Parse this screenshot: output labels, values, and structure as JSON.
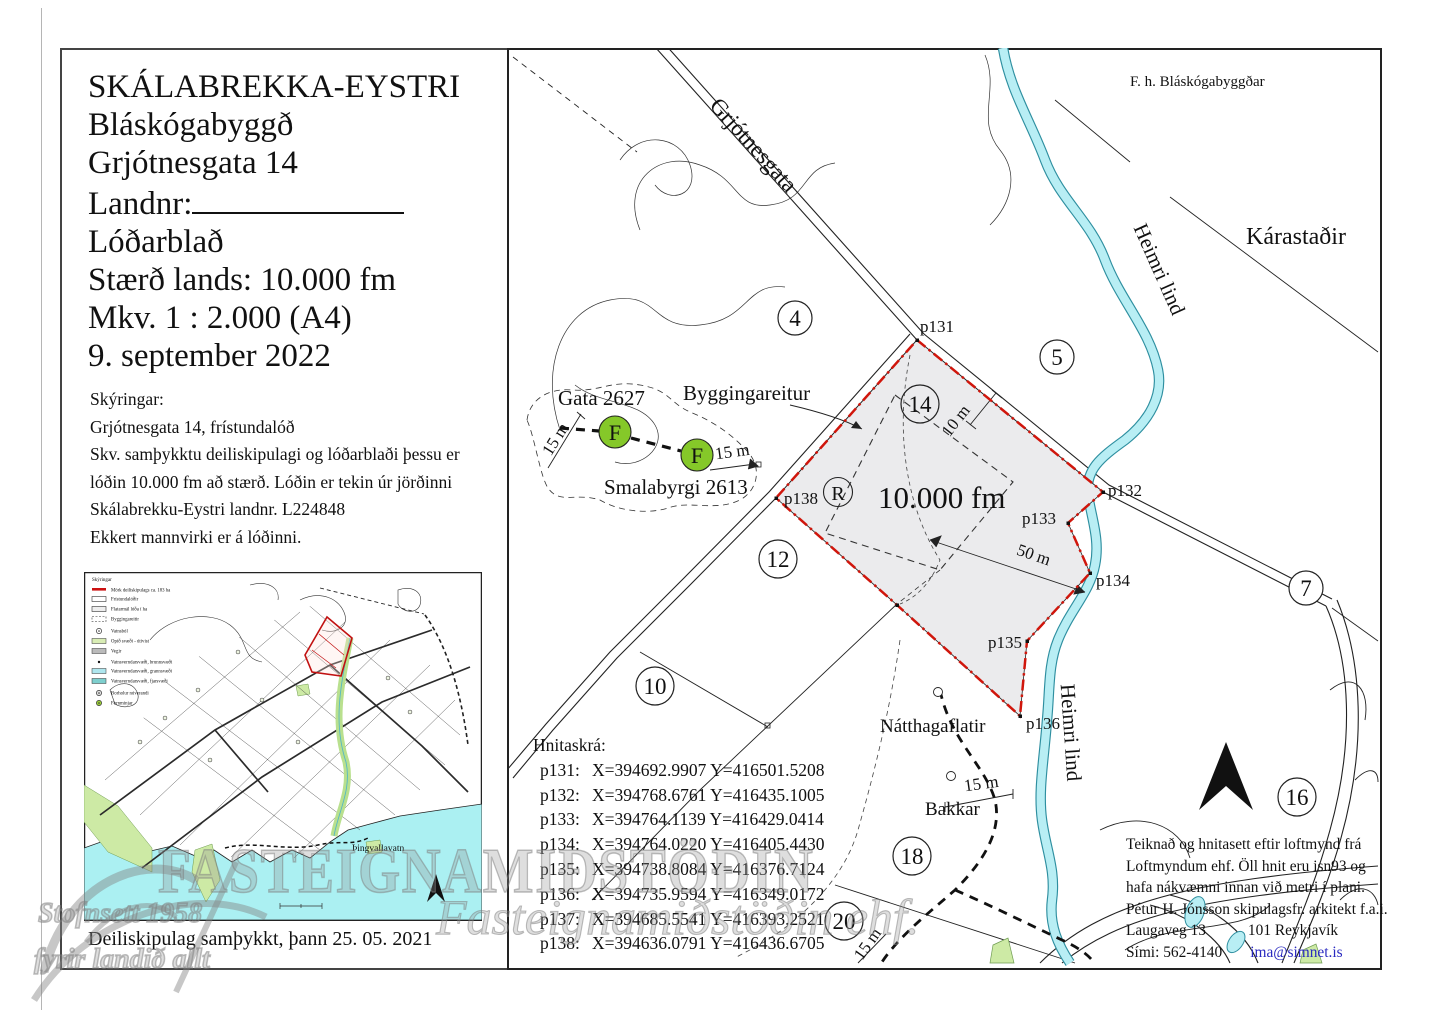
{
  "title_block": {
    "property": "SKÁLABREKKA-EYSTRI",
    "municipality": "Bláskógabyggð",
    "address": "Grjótnesgata 14",
    "landnr_label": "Landnr:",
    "doc_type": "Lóðarblað",
    "size": "Stærð lands: 10.000 fm",
    "scale": "Mkv. 1 : 2.000 (A4)",
    "date": "9. september 2022"
  },
  "skyringar": {
    "heading": "Skýringar:",
    "line1": "Grjótnesgata 14, frístundalóð",
    "line2": "Skv. samþykktu deiliskipulagi og lóðarblaði þessu er",
    "line3": "lóðin 10.000 fm að stærð.   Lóðin er tekin úr jörðinni",
    "line4": "Skálabrekku-Eystri landnr. L224848",
    "line5": "Ekkert mannvirki er á lóðinni."
  },
  "hnitaskra": {
    "heading": "Hnitaskrá:",
    "rows": [
      {
        "id": "p131:",
        "coords": "X=394692.9907 Y=416501.5208"
      },
      {
        "id": "p132:",
        "coords": "X=394768.6761 Y=416435.1005"
      },
      {
        "id": "p133:",
        "coords": "X=394764.1139 Y=416429.0414"
      },
      {
        "id": "p134:",
        "coords": "X=394764.0220 Y=416405.4430"
      },
      {
        "id": "p135:",
        "coords": "X=394738.8084 Y=416376.7124"
      },
      {
        "id": "p136:",
        "coords": "X=394735.9594 Y=416349.0172"
      },
      {
        "id": "p137:",
        "coords": "X=394685.5541 Y=416393.2521"
      },
      {
        "id": "p138:",
        "coords": "X=394636.0791 Y=416436.6705"
      }
    ]
  },
  "attribution": {
    "line1": "Teiknað og hnitasett eftir loftmynd frá",
    "line2": "Loftmyndum ehf.  Öll hnit eru isn93 og",
    "line3": "hafa nákvæmni innan við metri í plani.",
    "line4": "Pétur H. Jónsson skipulagsfr. arkitekt f.a.i.",
    "address": "Laugaveg 13",
    "city": "101 Reykjavík",
    "phone": "Sími: 562-4140",
    "email": "ima@simnet.is"
  },
  "map": {
    "on_behalf": "F. h. Bláskógabyggðar",
    "karastadir": "Kárastaðir",
    "road": "Grjótnesgata",
    "stream": "Heimri lind",
    "stream2": "Heimri lind",
    "area": "10.000 fm",
    "building_envelope": "Byggingareitur",
    "gata": "Gata 2627",
    "smalabyrgi": "Smalabyrgi 2613",
    "natthagaflatir": "Nátthagaflatir",
    "bakkar": "Bakkar",
    "dim10": "10 m",
    "dim50": "50 m",
    "dim15": "15 m",
    "monument_letter": "F",
    "r_label": "R",
    "plots": {
      "n4": "4",
      "n5": "5",
      "n7": "7",
      "n10": "10",
      "n12": "12",
      "n14": "14",
      "n16": "16",
      "n18": "18",
      "n20": "20"
    },
    "points": {
      "p131": "p131",
      "p132": "p132",
      "p133": "p133",
      "p134": "p134",
      "p135": "p135",
      "p136": "p136",
      "p138": "p138"
    }
  },
  "inset": {
    "legend_title": "Skýringar",
    "legend": [
      {
        "label": "Mörk deiliskipulags ca. 183 ha"
      },
      {
        "label": "Frístundalóðir"
      },
      {
        "label": "Flatarmál lóða í ha"
      },
      {
        "label": "Byggingareitir"
      },
      {
        "label": "Vatnsból"
      },
      {
        "label": "Opið svæði - útivist"
      },
      {
        "label": "Vegir"
      },
      {
        "label": "Vatnsverndarsvæði, brunnsvæði"
      },
      {
        "label": "Vatnsverndarsvæði, grannsvæði"
      },
      {
        "label": "Vatnsverndarsvæði, fjarsvæði"
      },
      {
        "label": "Borholur núverandi"
      },
      {
        "label": "Fornminjar"
      }
    ],
    "lake": "Þingvallavatn",
    "caption": "Deiliskipulag samþykkt, þann 25. 05. 2021"
  },
  "watermark": {
    "big": "FASTEIGNAMIÐSTÖÐIN",
    "script": "Fasteignamiðstöðin ehf.",
    "line1": "Stofnsett 1958",
    "line2": "fyrir landið allt"
  },
  "colors": {
    "boundary_red": "#d0160c",
    "stream_fill": "#b8eef4",
    "monument_green": "#85c829",
    "label_blue": "#2222b4",
    "plot_fill": "#ebebed",
    "lake": "#abf0f2",
    "open_green": "#cdeaa5"
  }
}
